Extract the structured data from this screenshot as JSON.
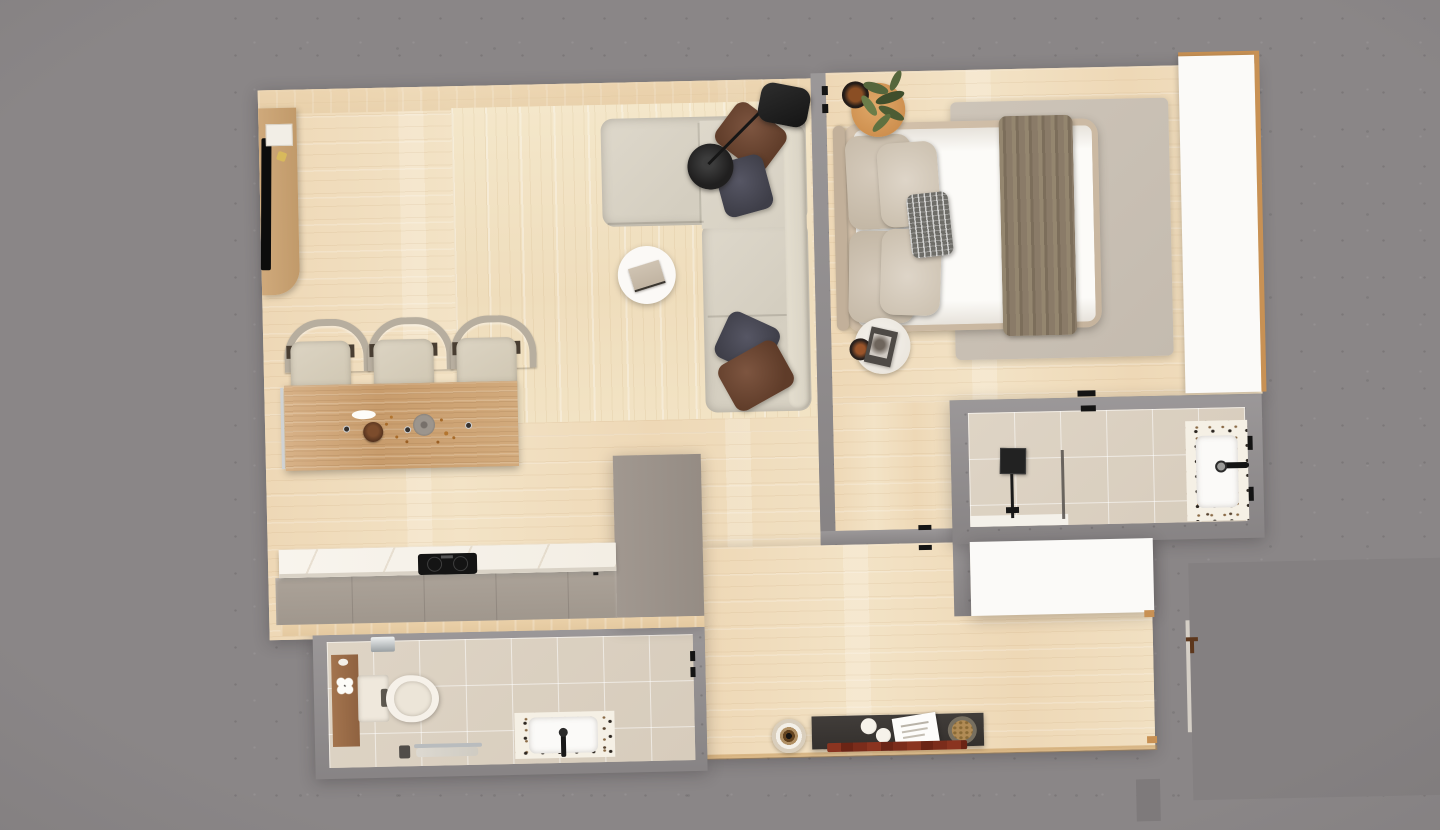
{
  "scene": {
    "kind": "apartment-floor-plan",
    "view": "top-down-3d-render",
    "background": "speckled-concrete"
  },
  "palette": {
    "concrete": "#8a8687",
    "concrete_dark": "#848081",
    "wall": "#908c8d",
    "wood_floor": "#efdcbd",
    "wood_floor_light": "#f3e6c9",
    "wood_warm": "#e7cda6",
    "wood_island": "#cda476",
    "wood_console": "#c8a273",
    "wood_mat": "#9a6b46",
    "tile": "#dbd1c2",
    "terrazzo": "#f5f0e5",
    "white": "#fbfaf8",
    "marble": "#f7f3ec",
    "cabinet": "#a69d94",
    "cabinet_tall": "#9b9289",
    "sofa": "#d9d3c6",
    "pillow_brown": "#6b4531",
    "pillow_gray": "#474651",
    "black": "#1d1d1d",
    "bed_frame": "#cdbba4",
    "mattress": "#fcfbf8",
    "pillow_bed": "#cec2b1",
    "throw": "#8a7b68",
    "rug_bedroom": "#c9c0b4",
    "nightstand_orange": "#d7995a",
    "accent_rust": "#8a4e24",
    "plant_green": "#55663c",
    "runner_red": "#7b2c1b",
    "console_dark": "#3a3734",
    "trim_wood": "#c89154",
    "chrome": "#b9bcbe"
  },
  "rooms": [
    {
      "id": "living-room",
      "furniture": [
        "sectional-sofa",
        "throw-pillows-brown-and-gray",
        "arc-floor-lamp",
        "round-side-table",
        "book",
        "wood-area-rug",
        "media-console",
        "tv",
        "dining-island",
        "bar-stool",
        "bar-stool",
        "bar-stool",
        "serving-bowl",
        "plate",
        "oval-dish"
      ]
    },
    {
      "id": "kitchen",
      "furniture": [
        "marble-counter",
        "induction-cooktop",
        "base-cabinets",
        "tall-cabinet"
      ]
    },
    {
      "id": "bedroom",
      "furniture": [
        "double-bed",
        "headboard",
        "bed-pillows",
        "striped-cushion",
        "throw-blanket",
        "area-rug",
        "round-nightstand-orange",
        "round-nightstand-white",
        "potted-plant",
        "black-tray",
        "magazine",
        "wardrobe"
      ]
    },
    {
      "id": "bathroom",
      "furniture": [
        "toilet",
        "wood-bath-mat",
        "towel-rail",
        "terrazzo-vanity-sink",
        "black-faucet"
      ]
    },
    {
      "id": "shower-room",
      "furniture": [
        "rain-shower-head",
        "glass-screen",
        "shower-tray",
        "terrazzo-vanity-sink",
        "wall-faucet"
      ]
    },
    {
      "id": "hallway",
      "furniture": [
        "console-table",
        "paper-stack",
        "ceramic-plates",
        "bread-basket",
        "red-runner-rug",
        "decorative-ceramic-bowl",
        "white-storage-unit"
      ]
    },
    {
      "id": "entry",
      "furniture": [
        "front-door",
        "door-handle",
        "entry-landing"
      ]
    }
  ]
}
